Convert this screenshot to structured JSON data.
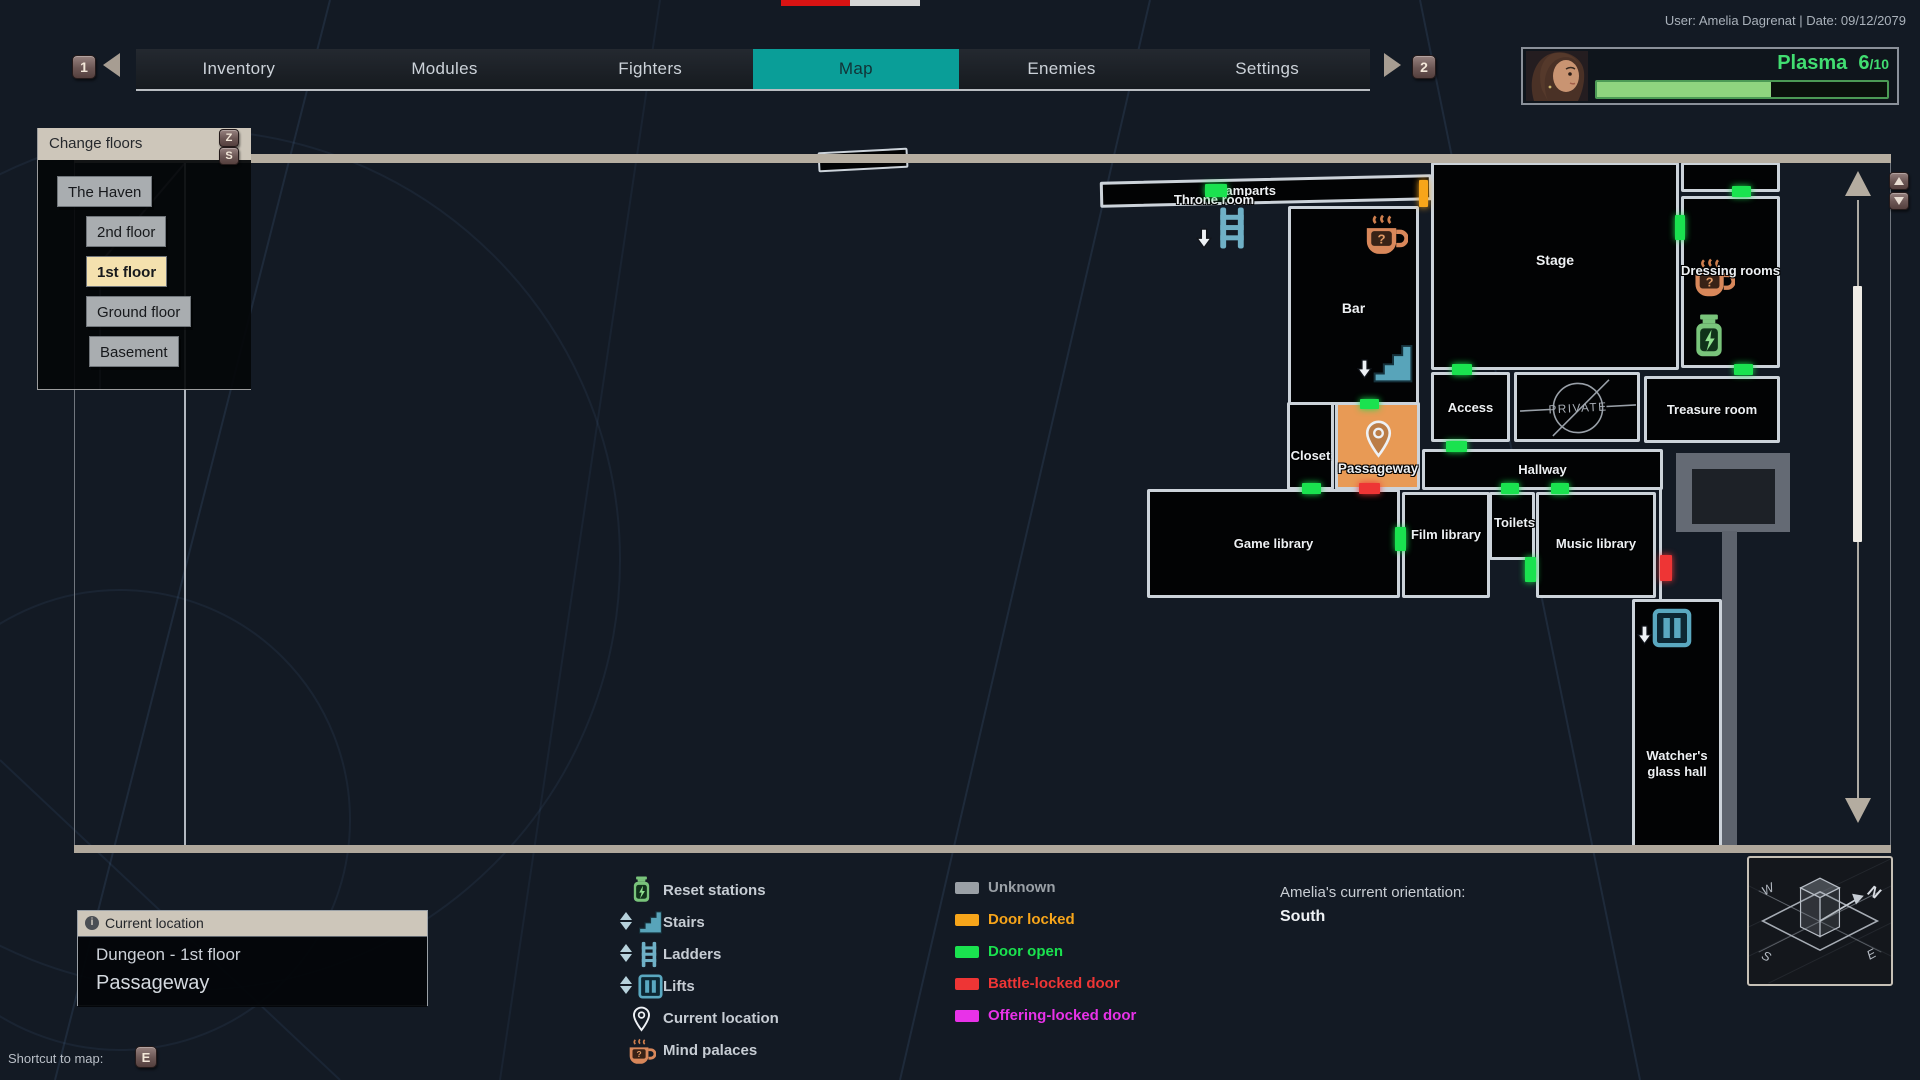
{
  "top": {
    "user_info": "User: Amelia Dagrenat | Date: 09/12/2079"
  },
  "tabs": {
    "items": [
      {
        "label": "Inventory"
      },
      {
        "label": "Modules"
      },
      {
        "label": "Fighters"
      },
      {
        "label": "Map"
      },
      {
        "label": "Enemies"
      },
      {
        "label": "Settings"
      }
    ],
    "selected": "Map",
    "prev_key": "1",
    "next_key": "2"
  },
  "player": {
    "resource_label": "Plasma",
    "resource_value": "6",
    "resource_max": "/10",
    "fill_pct": 60,
    "resource_color": "#41dd71"
  },
  "floors": {
    "title": "Change floors",
    "key_up": "Z",
    "key_down": "S",
    "items": [
      {
        "label": "The Haven",
        "selected": false
      },
      {
        "label": "2nd floor",
        "selected": false
      },
      {
        "label": "1st floor",
        "selected": true
      },
      {
        "label": "Ground floor",
        "selected": false
      },
      {
        "label": "Basement",
        "selected": false
      }
    ]
  },
  "map": {
    "labels": {
      "ramparts": "Ramparts",
      "throne_room": "Throne room",
      "bar": "Bar",
      "stage": "Stage",
      "dressing_rooms": "Dressing rooms",
      "access": "Access",
      "private": "PRIVATE",
      "treasure_room": "Treasure room",
      "closet": "Closet",
      "passageway": "Passageway",
      "hallway": "Hallway",
      "game_library": "Game library",
      "film_library": "Film library",
      "toilets": "Toilets",
      "music_library": "Music library",
      "watchers_glass_hall": "Watcher's glass hall"
    },
    "door_colors": {
      "unknown": "#9aa0a2",
      "locked": "#f7a51a",
      "open": "#1ae24f",
      "battle": "#ee3535",
      "offering": "#e832e8"
    },
    "doors": [
      {
        "x": 1205,
        "y": 184,
        "w": 22,
        "h": 13,
        "type": "open"
      },
      {
        "x": 1419,
        "y": 180,
        "w": 9,
        "h": 27,
        "type": "locked"
      },
      {
        "x": 1360,
        "y": 399,
        "w": 19,
        "h": 10,
        "type": "open"
      },
      {
        "x": 1675,
        "y": 215,
        "w": 10,
        "h": 25,
        "type": "open"
      },
      {
        "x": 1732,
        "y": 186,
        "w": 19,
        "h": 11,
        "type": "open"
      },
      {
        "x": 1452,
        "y": 364,
        "w": 20,
        "h": 11,
        "type": "open"
      },
      {
        "x": 1734,
        "y": 364,
        "w": 19,
        "h": 11,
        "type": "open"
      },
      {
        "x": 1302,
        "y": 483,
        "w": 19,
        "h": 11,
        "type": "open"
      },
      {
        "x": 1359,
        "y": 483,
        "w": 21,
        "h": 11,
        "type": "battle"
      },
      {
        "x": 1446,
        "y": 441,
        "w": 21,
        "h": 11,
        "type": "open"
      },
      {
        "x": 1501,
        "y": 483,
        "w": 18,
        "h": 11,
        "type": "open"
      },
      {
        "x": 1551,
        "y": 483,
        "w": 18,
        "h": 11,
        "type": "open"
      },
      {
        "x": 1395,
        "y": 527,
        "w": 11,
        "h": 24,
        "type": "open"
      },
      {
        "x": 1525,
        "y": 557,
        "w": 11,
        "h": 25,
        "type": "open"
      },
      {
        "x": 1660,
        "y": 555,
        "w": 12,
        "h": 26,
        "type": "battle"
      }
    ]
  },
  "legend": {
    "icons": [
      {
        "name": "reset-stations",
        "label": "Reset stations"
      },
      {
        "name": "stairs",
        "label": "Stairs"
      },
      {
        "name": "ladders",
        "label": "Ladders"
      },
      {
        "name": "lifts",
        "label": "Lifts"
      },
      {
        "name": "current-location",
        "label": "Current location"
      },
      {
        "name": "mind-palaces",
        "label": "Mind palaces"
      }
    ],
    "doors": [
      {
        "label": "Unknown",
        "color": "#9aa0a6"
      },
      {
        "label": "Door locked",
        "color": "#f7a51a"
      },
      {
        "label": "Door open",
        "color": "#1ae24f"
      },
      {
        "label": "Battle-locked door",
        "color": "#ee3535"
      },
      {
        "label": "Offering-locked door",
        "color": "#e832e8"
      }
    ]
  },
  "orientation": {
    "label": "Amelia's current orientation:",
    "value": "South"
  },
  "current_location": {
    "title": "Current location",
    "area": "Dungeon - 1st floor",
    "room": "Passageway"
  },
  "shortcut": {
    "label": "Shortcut to map:",
    "key": "E"
  },
  "compass": {
    "n": "N",
    "s": "S",
    "e": "E",
    "w": "W"
  }
}
